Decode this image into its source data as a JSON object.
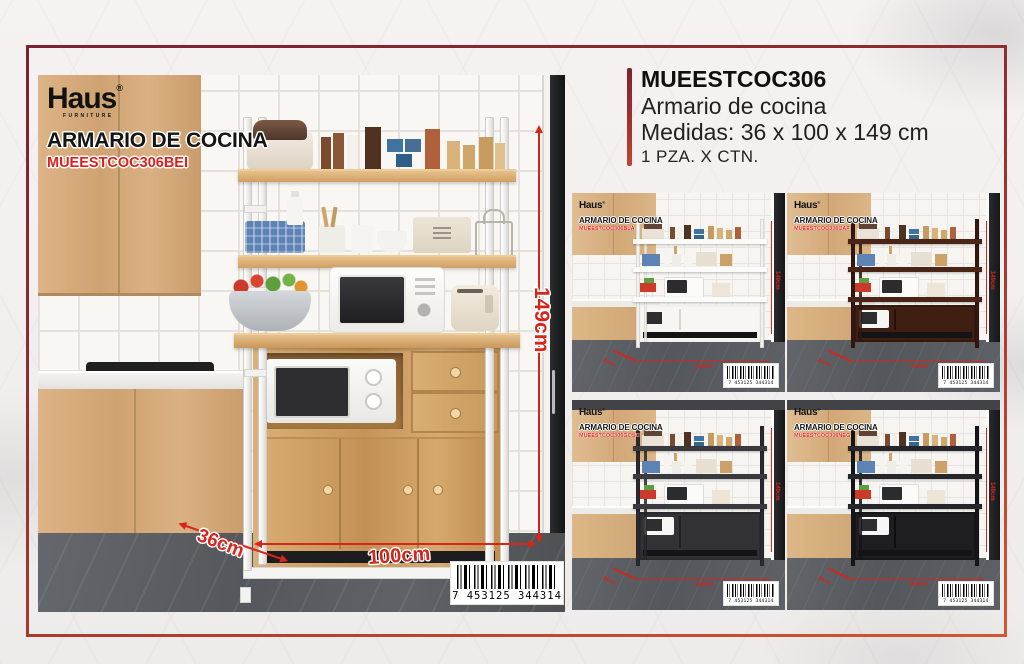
{
  "header": {
    "sku": "MUEESTCOC306",
    "name": "Armario de cocina",
    "measures": "Medidas: 36 x 100 x 149 cm",
    "packing": "1 PZA. X CTN."
  },
  "brand": {
    "name": "Haus",
    "reg": "®",
    "sub": "FURNITURE"
  },
  "main": {
    "title": "ARMARIO DE COCINA",
    "sku": "MUEESTCOC306BEI",
    "dim_height": "149cm",
    "dim_width": "100cm",
    "dim_depth": "36cm",
    "barcode": "7 453125 344314"
  },
  "variants": [
    {
      "title": "ARMARIO DE COCINA",
      "sku": "MUEESTCOC306BLA",
      "dim_height": "149cm",
      "dim_width": "100cm",
      "dim_depth": "36cm",
      "barcode": "7 453125 344314",
      "style_vars": "--frame:#f2f1ee;--shelf:#fbfbfa;--panel:#f7f6f3;--panelline:#d9d6d0"
    },
    {
      "title": "ARMARIO DE COCINA",
      "sku": "MUEESTCOC306CAF",
      "dim_height": "149cm",
      "dim_width": "100cm",
      "dim_depth": "36cm",
      "barcode": "7 453125 344314",
      "style_vars": "--frame:#33180f;--shelf:#4a2416;--panel:#3f1f12;--panelline:#24100a"
    },
    {
      "title": "ARMARIO DE COCINA",
      "sku": "MUEESTCOC306GOSC",
      "dim_height": "149cm",
      "dim_width": "100cm",
      "dim_depth": "36cm",
      "barcode": "7 453125 344314",
      "style_vars": "--frame:#2a2a2e;--shelf:#3a3a3e;--panel:#323236;--panelline:#1e1e22"
    },
    {
      "title": "ARMARIO DE COCINA",
      "sku": "MUEESTCOC306NEG",
      "dim_height": "149cm",
      "dim_width": "100cm",
      "dim_depth": "36cm",
      "barcode": "7 453125 344314",
      "style_vars": "--frame:#161618;--shelf:#26262a;--panel:#1e1e21;--panelline:#0e0e10"
    }
  ],
  "colors": {
    "accent_red": "#e01e1c",
    "dimension_red": "#d6261c",
    "frame_border_top": "#7c2130",
    "frame_border_bottom": "#d1572e"
  }
}
